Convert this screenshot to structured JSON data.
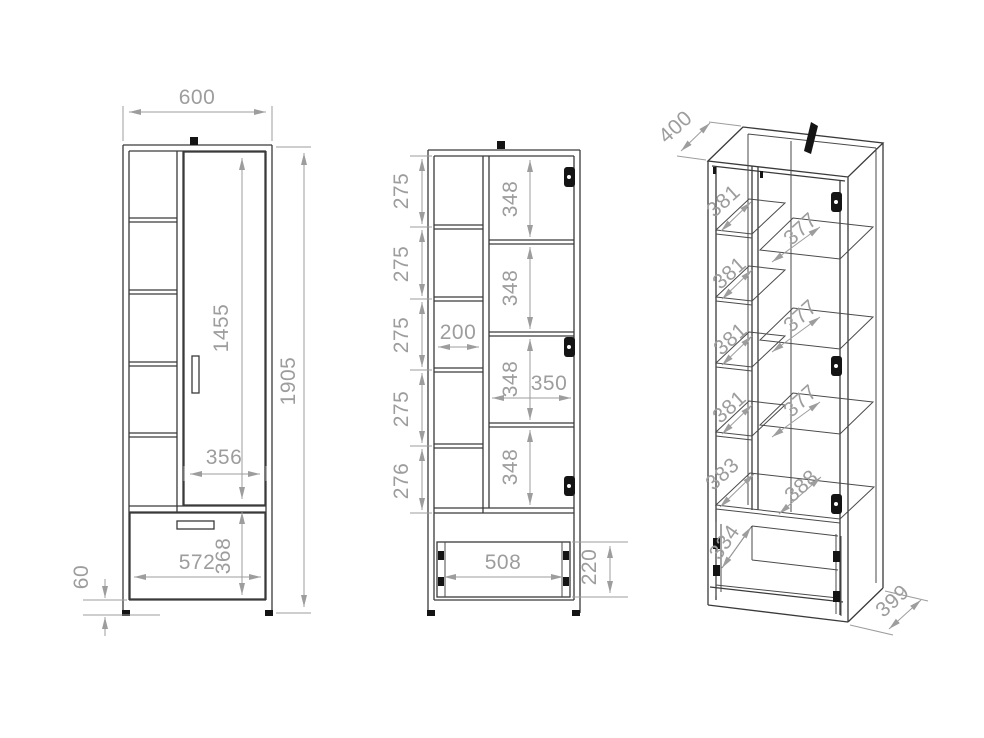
{
  "drawing": {
    "title": "wardrobe-dimension-drawing",
    "background_color": "#ffffff",
    "line_color": "#3a3a3a",
    "dim_color": "#9d9d9d",
    "views": {
      "front": {
        "label": "front-view-closed",
        "dims": {
          "overall_width": "600",
          "overall_height": "1905",
          "door_height": "1455",
          "door_width": "356",
          "drawer_front_width": "572",
          "drawer_front_height": "368",
          "plinth_height": "60"
        }
      },
      "front_open": {
        "label": "front-view-open",
        "dims": {
          "shelf_gaps_left": [
            "275",
            "275",
            "275",
            "275",
            "276"
          ],
          "shelf_gaps_right": [
            "348",
            "348",
            "348",
            "348"
          ],
          "left_column_inner_width": "200",
          "right_column_inner_width": "350",
          "drawer_inner_width": "508",
          "drawer_box_height": "220"
        }
      },
      "isometric": {
        "label": "isometric-view",
        "dims": {
          "top_depth": "400",
          "left_shelf_depths": [
            "381",
            "381",
            "381",
            "381",
            "383"
          ],
          "right_shelf_depths": [
            "377",
            "377",
            "377",
            "388"
          ],
          "drawer_inner_depth": "334",
          "base_depth": "399"
        }
      }
    }
  }
}
